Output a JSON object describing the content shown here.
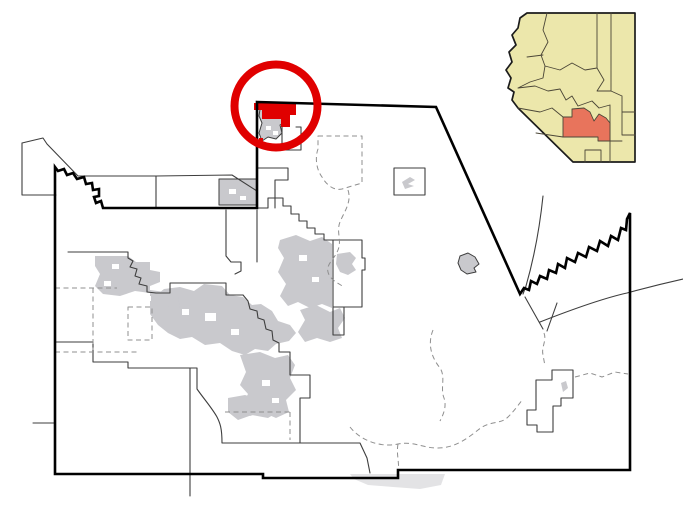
{
  "map": {
    "kind": "county-locator-map",
    "inset_position": "top-right"
  },
  "colors": {
    "background": "#ffffff",
    "county_border": "#000000",
    "boundary_thin": "#3e3e3e",
    "boundary_dashed": "#8f8f8f",
    "urban_area": "#c9c9cd",
    "urban_faint": "#e3e3e5",
    "hole_white": "#ffffff",
    "highlight_red": "#e00000",
    "inset_state_fill": "#ece7ab",
    "inset_border": "#1c1c1c",
    "inset_county_line": "#4b4637",
    "inset_highlight": "#e8745c"
  }
}
